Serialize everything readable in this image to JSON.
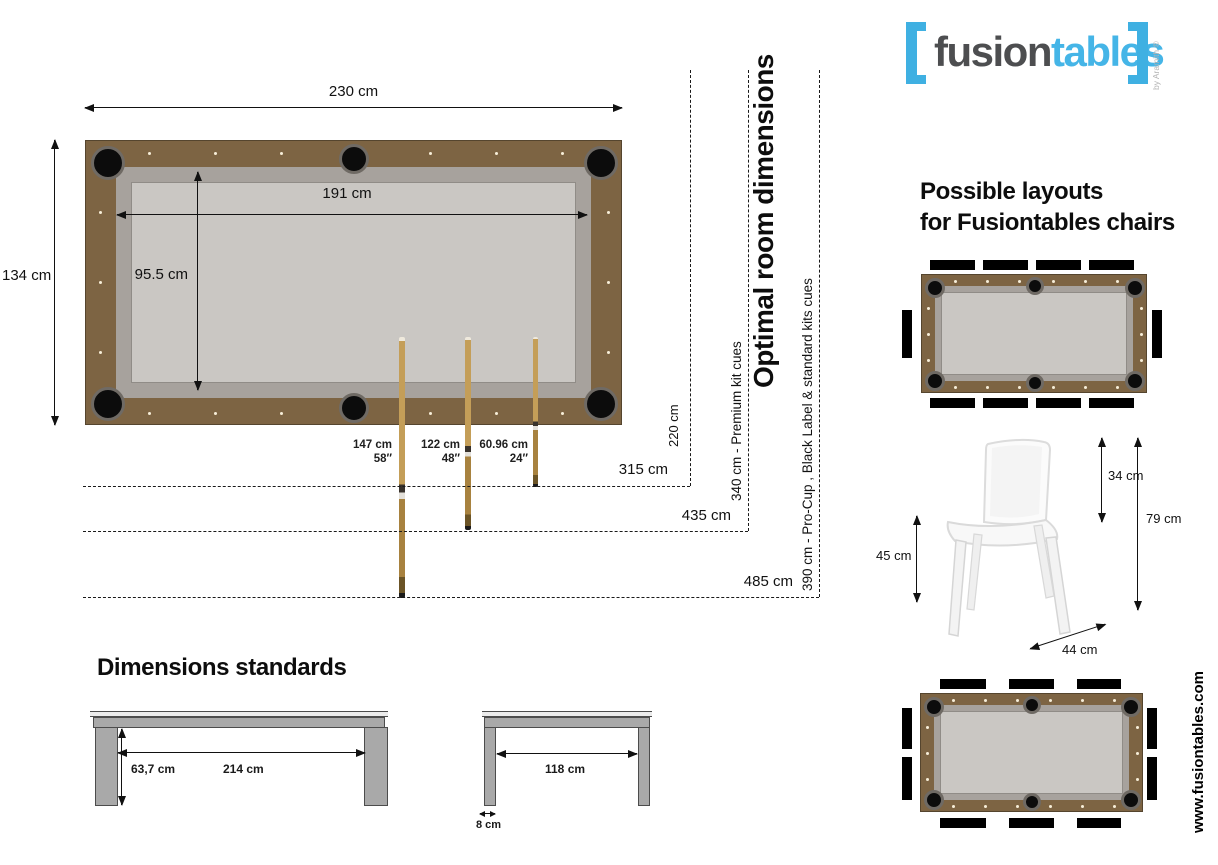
{
  "logo": {
    "fusion": "fusion",
    "tables": "tables",
    "byline": "by Aramith ®"
  },
  "website": "www.fusiontables.com",
  "pool_table": {
    "outer_width": "230 cm",
    "playfield_width": "191 cm",
    "outer_depth": "134 cm",
    "playfield_depth": "95.5 cm"
  },
  "cues": [
    {
      "cm": "147 cm",
      "inches": "58′′"
    },
    {
      "cm": "122 cm",
      "inches": "48′′"
    },
    {
      "cm": "60.96 cm",
      "inches": "24′′"
    }
  ],
  "room": {
    "title": "Optimal room dimensions",
    "side_clearance": "220 cm",
    "min_width": "315 cm",
    "mid_width": "435 cm",
    "max_width": "485 cm",
    "premium_note": "340 cm - Premium kit cues",
    "procup_note": "390 cm - Pro-Cup , Black Label & standard kits cues"
  },
  "layouts": {
    "title_line1": "Possible layouts",
    "title_line2": "for Fusiontables chairs"
  },
  "chair": {
    "backrest_height": "34 cm",
    "total_height": "79 cm",
    "seat_height": "45 cm",
    "seat_depth": "44 cm"
  },
  "standards": {
    "title": "Dimensions standards",
    "side_view": {
      "leg_height": "63,7 cm",
      "leg_span": "214 cm"
    },
    "end_view": {
      "leg_span": "118 cm",
      "leg_width": "8 cm"
    }
  },
  "colors": {
    "brand_blue": "#3fb0e2",
    "logo_dark": "#4d4e50",
    "frame_brown": "#7d6443",
    "rail_gray": "#a7a29d",
    "cloth_gray": "#cac7c3",
    "bench_black": "#000000"
  }
}
